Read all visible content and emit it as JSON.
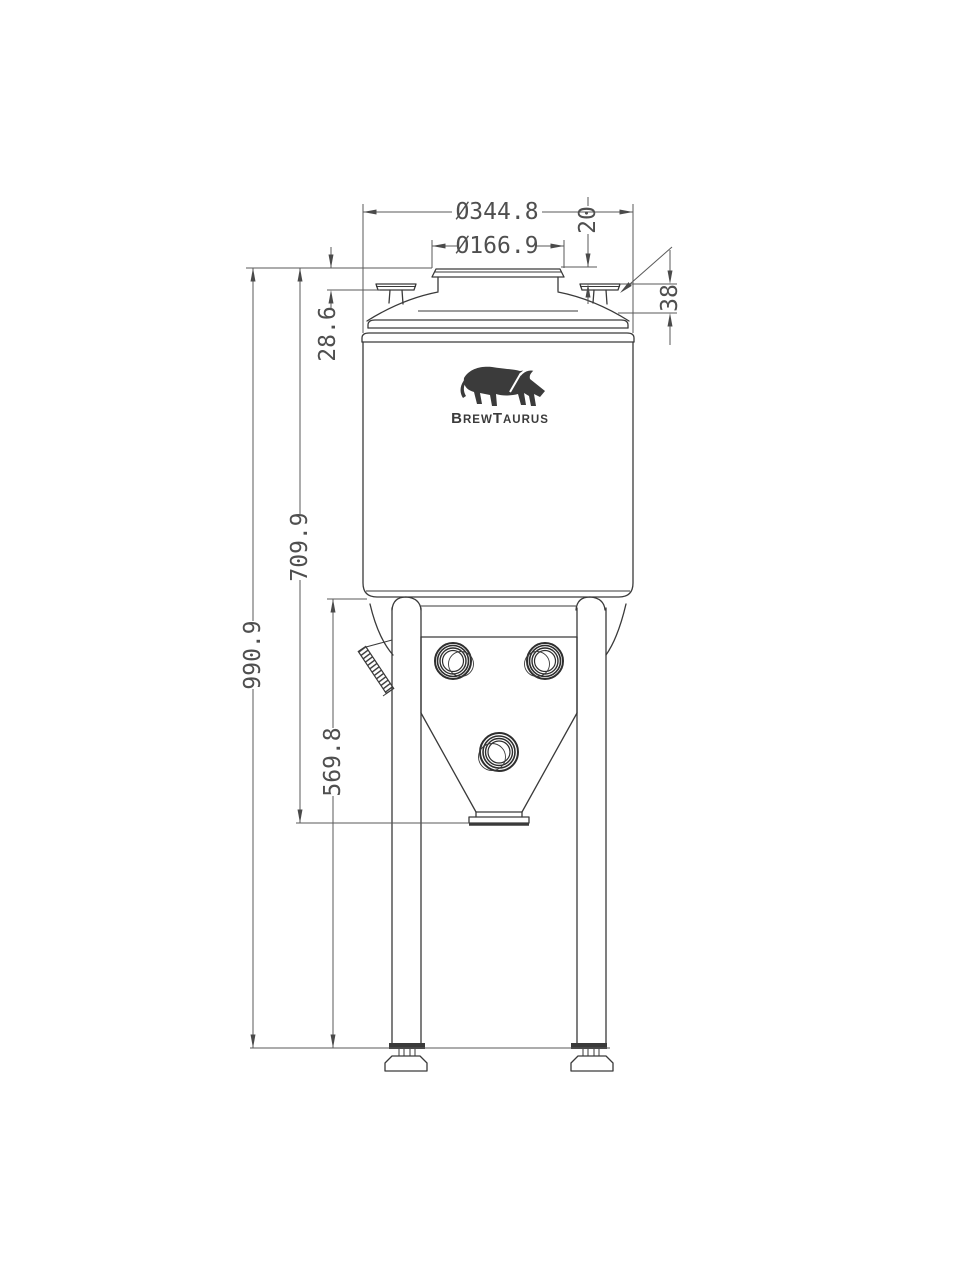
{
  "drawing": {
    "brand": {
      "b": "B",
      "rew": "REW",
      "t": "T",
      "aurus": "AURUS"
    },
    "dims": {
      "overall_diameter": "Ø344.8",
      "opening_diameter": "Ø166.9",
      "neck_to_port_top": "20",
      "port_flange_height": "38",
      "lid_to_port_flange": "28.6",
      "top_to_cone_outlet": "709.9",
      "total_height": "990.9",
      "cone_top_to_ground": "569.8"
    },
    "colors": {
      "ink": "#3a3a3a",
      "dim_ink": "#4f4f4f",
      "background": "#ffffff"
    }
  }
}
